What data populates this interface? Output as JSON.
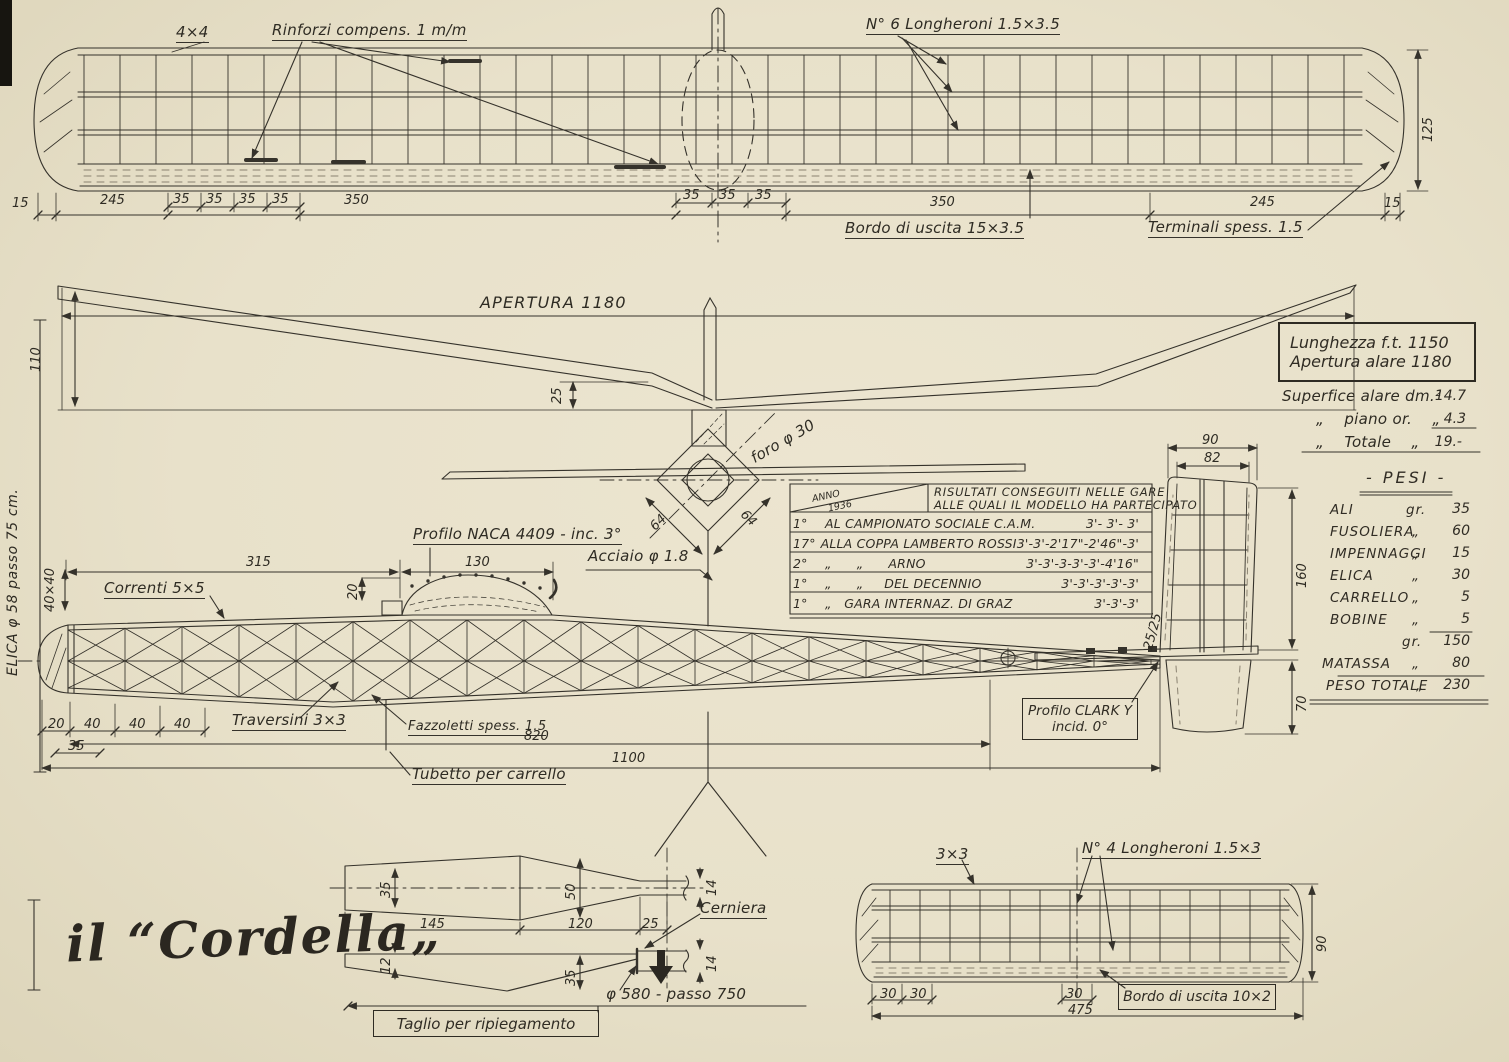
{
  "page": {
    "signature": "il “Cordella„"
  },
  "wing_top": {
    "label_4x4": "4×4",
    "label_rinforzi": "Rinforzi compens. 1 m/m",
    "label_longheroni": "N° 6 Longheroni 1.5×3.5",
    "label_bordo": "Bordo di uscita 15×3.5",
    "label_terminali": "Terminali spess. 1.5",
    "dim_tip": "125",
    "dims": [
      "15",
      "245",
      "35",
      "35",
      "35",
      "35",
      "350",
      "35",
      "35",
      "35",
      "350",
      "245",
      "15"
    ]
  },
  "front_view": {
    "label_apertura": "APERTURA 1180",
    "dim_height": "110",
    "dim_dihedral": "25"
  },
  "cross_section": {
    "dim_64_left": "64",
    "dim_64_right": "64",
    "label_foro": "foro φ 30",
    "label_acciaio": "Acciaio φ 1.8"
  },
  "specs_box": {
    "line1": "Lunghezza f.t. 1150",
    "line2": "Apertura alare 1180"
  },
  "surface_table": {
    "rows": [
      {
        "label": "Superfice alare dm.²",
        "value": "14.7"
      },
      {
        "label": "„    piano or.    „",
        "value": "4.3"
      },
      {
        "label": "„    Totale    „",
        "value": "19.-"
      }
    ]
  },
  "pesi": {
    "title": "- PESI -",
    "rows": [
      {
        "item": "ALI",
        "unit": "gr.",
        "value": "35"
      },
      {
        "item": "FUSOLIERA",
        "unit": "„",
        "value": "60"
      },
      {
        "item": "IMPENNAGGI",
        "unit": "„",
        "value": "15"
      },
      {
        "item": "ELICA",
        "unit": "„",
        "value": "30"
      },
      {
        "item": "CARRELLO",
        "unit": "„",
        "value": "5"
      },
      {
        "item": "BOBINE",
        "unit": "„",
        "value": "5"
      }
    ],
    "subtotal_unit": "gr.",
    "subtotal_value": "150",
    "matassa": {
      "item": "MATASSA",
      "unit": "„",
      "value": "80"
    },
    "total": {
      "item": "PESO TOTALE",
      "unit": "„",
      "value": "230"
    }
  },
  "results": {
    "corner_top": "ANNO",
    "corner_year": "1936",
    "header_line1": "RISULTATI CONSEGUITI NELLE GARE",
    "header_line2": "ALLE QUALI IL MODELLO HA PARTECIPATO",
    "rows": [
      {
        "pos": "1°",
        "event": "AL CAMPIONATO SOCIALE C.A.M.",
        "times": "3'- 3'- 3'"
      },
      {
        "pos": "17°",
        "event": "ALLA COPPA LAMBERTO ROSSI",
        "times": "3'-3'-2'17\"-2'46\"-3'"
      },
      {
        "pos": "2°",
        "event": "„      „      ARNO",
        "times": "3'-3'-3-3'-3'-4'16\""
      },
      {
        "pos": "1°",
        "event": "„      „     DEL DECENNIO",
        "times": "3'-3'-3'-3'-3'"
      },
      {
        "pos": "1°",
        "event": "„   GARA INTERNAZ. DI GRAZ",
        "times": "3'-3'-3'"
      }
    ]
  },
  "fuselage": {
    "label_correnti": "Correnti 5×5",
    "label_naca": "Profilo NACA 4409 - inc. 3°",
    "dim_315": "315",
    "dim_130": "130",
    "dim_20": "20",
    "dim_40x40": "40×40",
    "label_elica": "ELICA φ 58 passo 75 cm.",
    "label_traversini": "Traversini 3×3",
    "label_fazzoletti": "Fazzoletti spess. 1.5",
    "label_tubetto": "Tubetto per carrello",
    "dim_820": "820",
    "dim_1100": "1100",
    "bottom_dims": [
      "20",
      "40",
      "40",
      "40"
    ],
    "dim_35": "35",
    "label_clark_1": "Profilo CLARK Y",
    "label_clark_2": "incid. 0°",
    "dim_25_25": "25/25"
  },
  "fin": {
    "dim_90": "90",
    "dim_82": "82",
    "dim_160": "160",
    "dim_70": "70"
  },
  "detail_views": {
    "dim_35_top": "35",
    "dim_50": "50",
    "dim_14_top": "14",
    "dim_145": "145",
    "dim_120": "120",
    "dim_25": "25",
    "label_cerniera": "Cerniera",
    "dim_12": "12",
    "dim_35_bottom": "35",
    "dim_14_bottom": "14",
    "label_elica_580": "φ 580 - passo 750",
    "label_taglio": "Taglio per ripiegamento"
  },
  "tailplane": {
    "label_3x3": "3×3",
    "label_longheroni": "N° 4 Longheroni 1.5×3",
    "dim_90": "90",
    "dims_30": [
      "30",
      "30",
      "30"
    ],
    "dim_475": "475",
    "label_bordo": "Bordo di uscita 10×2"
  }
}
